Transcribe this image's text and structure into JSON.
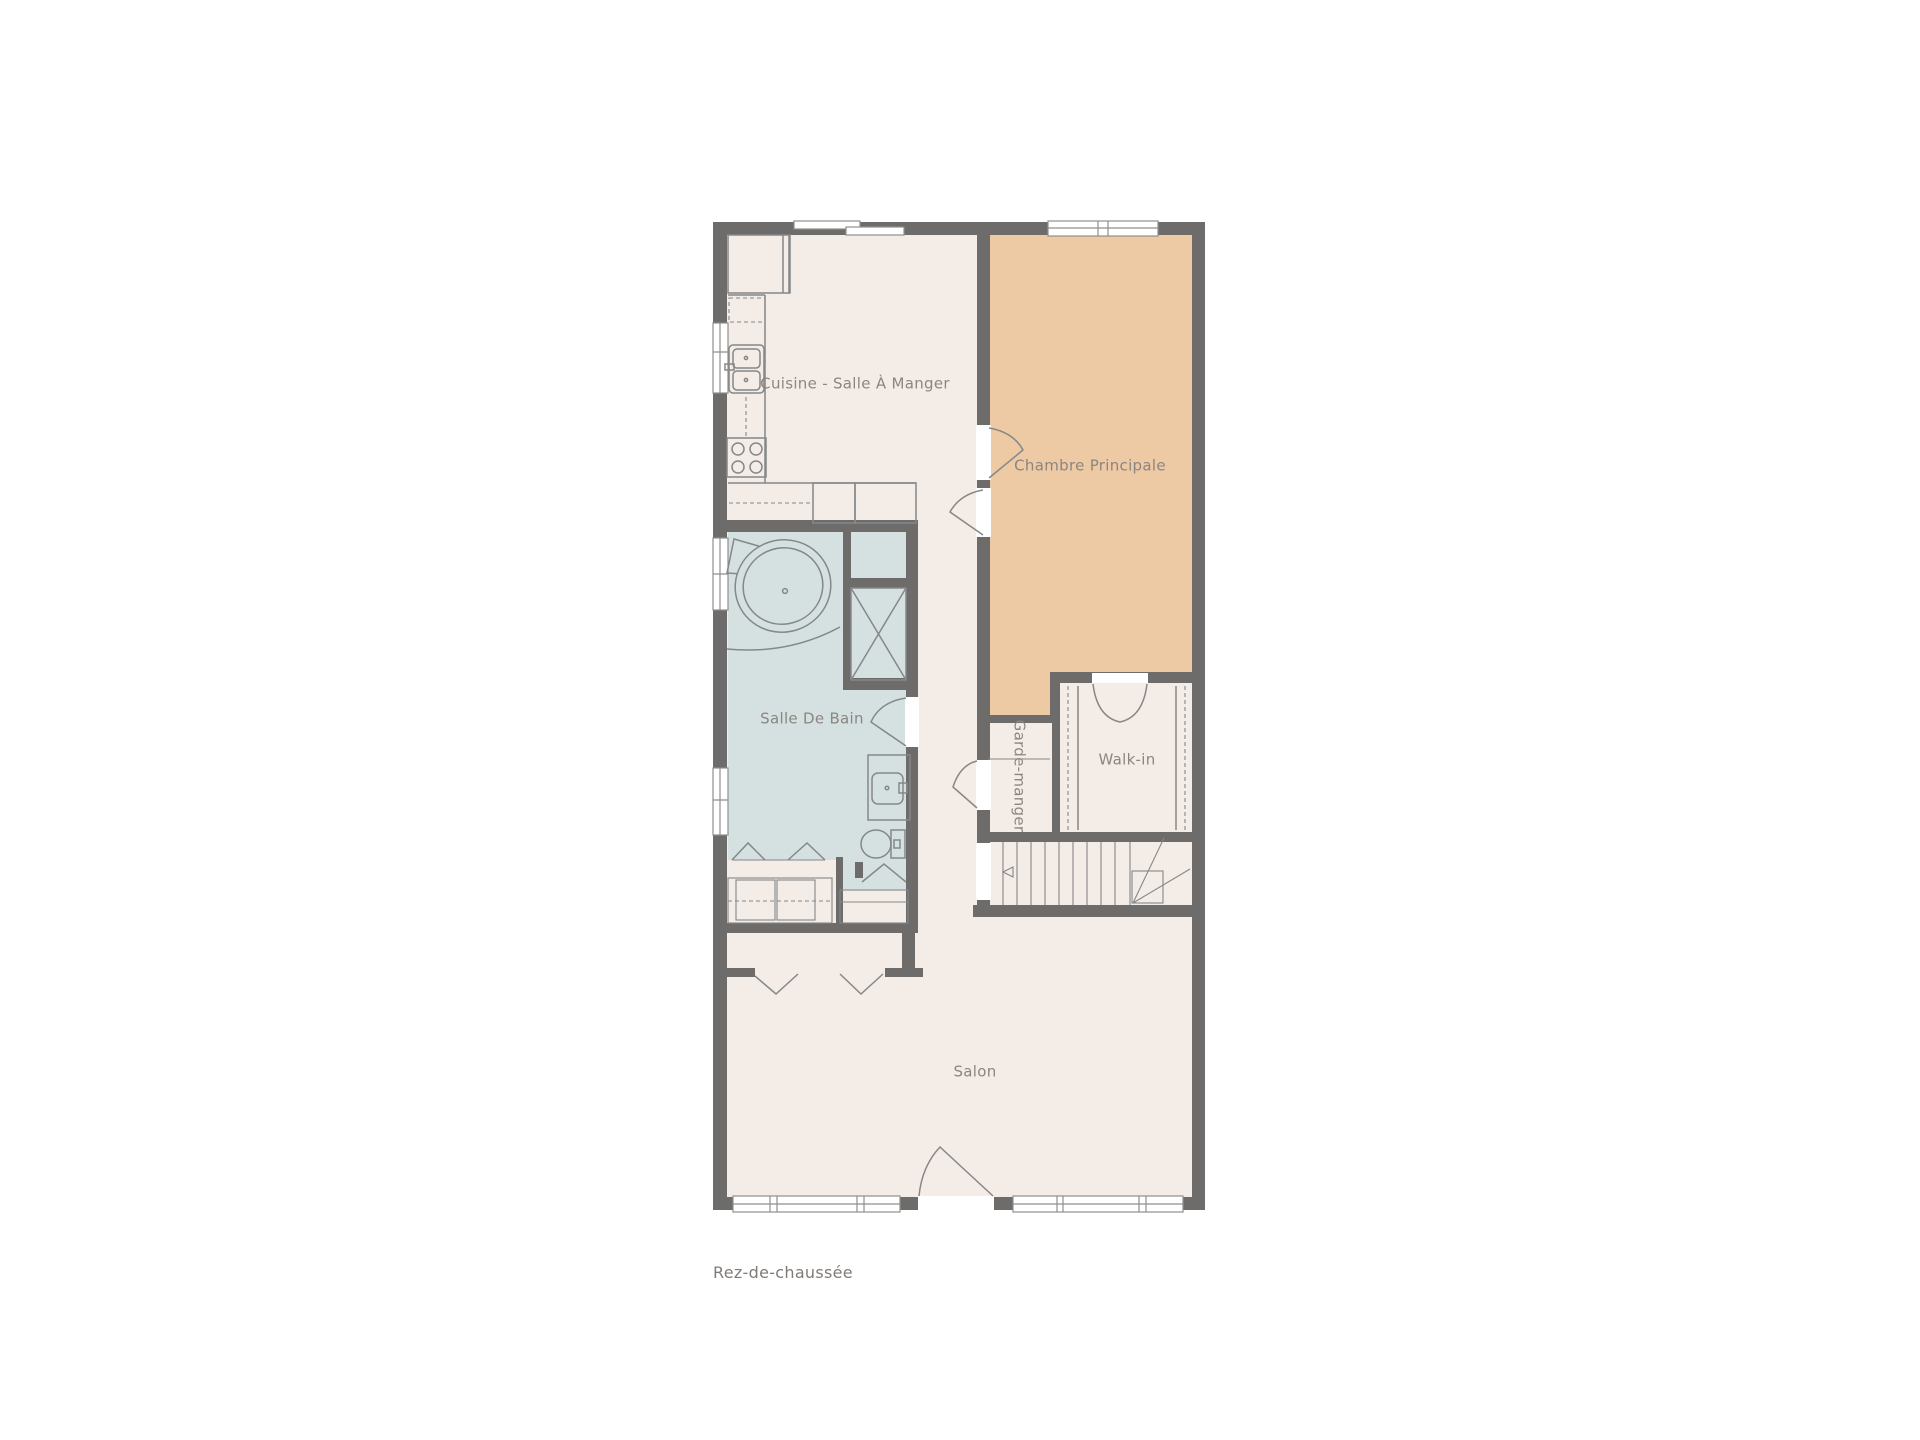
{
  "title": "Rez-de-chaussée",
  "rooms": {
    "kitchen": "Cuisine - Salle À Manger",
    "bedroom": "Chambre Principale",
    "bathroom": "Salle De Bain",
    "pantry": "Garde-manger",
    "walkin": "Walk-in",
    "living": "Salon"
  },
  "colors": {
    "background": "#ffffff",
    "floor": "#f4ece6",
    "bedroom_floor": "#edc9a4",
    "bathroom_floor": "#d5e1e1",
    "wall": "#6d6c6a",
    "fixture_line": "#85878a",
    "window_frame": "#8f8f8d",
    "label_text": "#8b8680"
  }
}
